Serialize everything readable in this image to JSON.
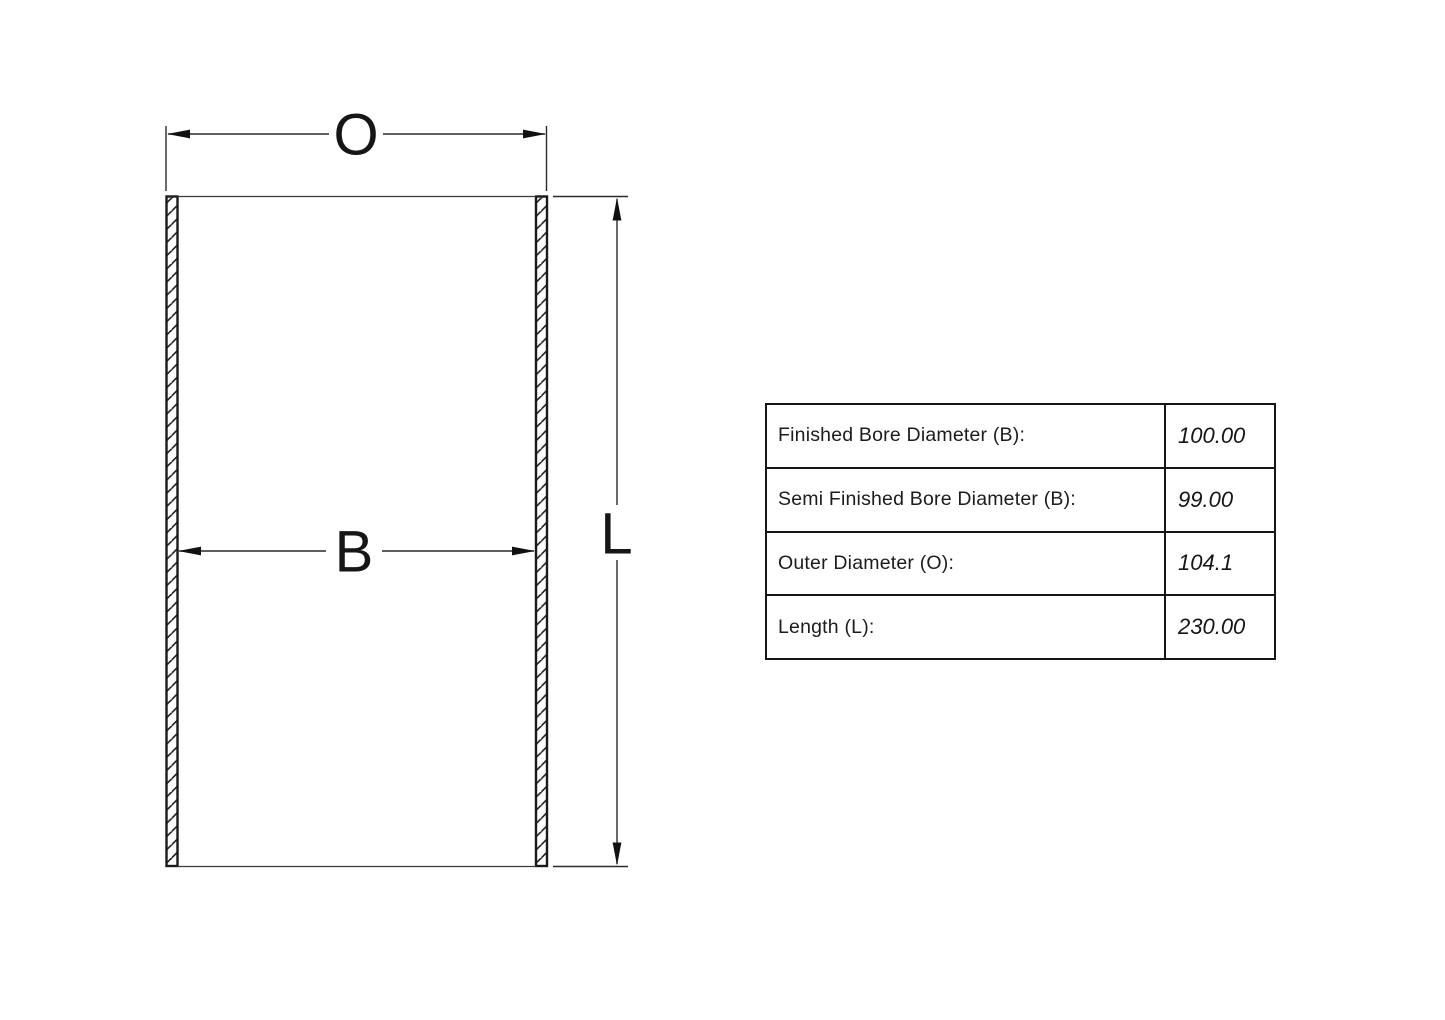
{
  "drawing": {
    "dim_labels": {
      "outer_diameter": "O",
      "bore": "B",
      "length": "L"
    }
  },
  "spec_table": {
    "rows": [
      {
        "label": "Finished Bore Diameter (B):",
        "value": "100.00"
      },
      {
        "label": "Semi Finished Bore Diameter (B):",
        "value": "99.00"
      },
      {
        "label": "Outer Diameter (O):",
        "value": "104.1"
      },
      {
        "label": "Length (L):",
        "value": "230.00"
      }
    ]
  },
  "colors": {
    "line": "#222222",
    "ink": "#161616",
    "background": "#ffffff"
  }
}
